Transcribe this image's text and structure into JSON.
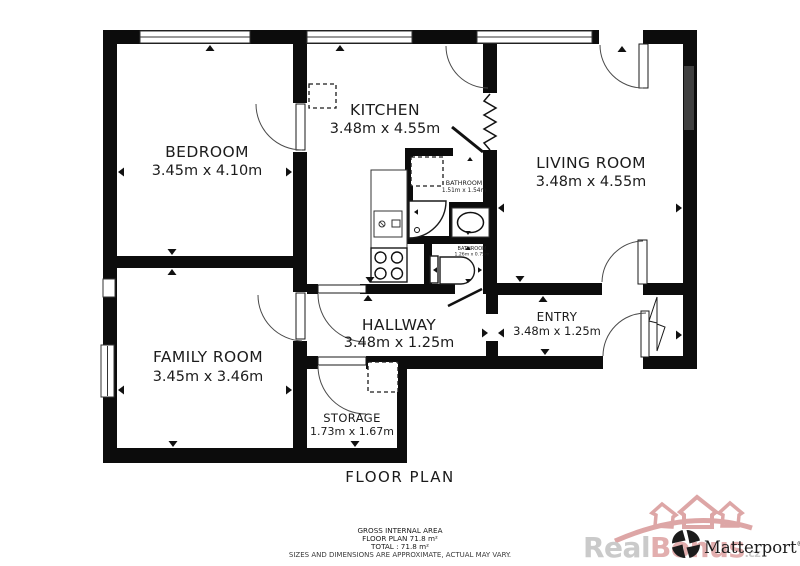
{
  "title": "FLOOR PLAN",
  "rooms": {
    "bedroom": {
      "name": "BEDROOM",
      "dims": "3.45m x 4.10m"
    },
    "kitchen": {
      "name": "KITCHEN",
      "dims": "3.48m x 4.55m"
    },
    "living_room": {
      "name": "LIVING ROOM",
      "dims": "3.48m x 4.55m"
    },
    "family_room": {
      "name": "FAMILY ROOM",
      "dims": "3.45m x 3.46m"
    },
    "hallway": {
      "name": "HALLWAY",
      "dims": "3.48m x 1.25m"
    },
    "entry": {
      "name": "ENTRY",
      "dims": "3.48m x 1.25m"
    },
    "storage": {
      "name": "STORAGE",
      "dims": "1.73m x 1.67m"
    },
    "bathroom": {
      "name": "BATHROOM",
      "dims": "1.51m x 1.54m"
    },
    "bathroom_small": {
      "name": "BATHROOM",
      "dims": "1.26m x 0.75m"
    }
  },
  "summary": {
    "gross_internal_area": "GROSS INTERNAL AREA",
    "floor_plan_area": "FLOOR PLAN 71.8 m²",
    "total_area": "TOTAL :  71.8 m²",
    "disclaimer": "SIZES AND DIMENSIONS ARE APPROXIMATE, ACTUAL MAY VARY."
  },
  "branding": {
    "watermark_prefix": "Real",
    "watermark_suffix": "Bonus",
    "watermark_domain": ".cz",
    "matterport_label": "Matterport",
    "matterport_reg": "®"
  },
  "colors": {
    "wall": "#0c0c0c",
    "watermark_gray": "#c6c6c6",
    "watermark_pink": "#e0a8a8",
    "crown_pink": "#db9f9f",
    "radiator_gray": "#3f3f3f",
    "logo_black": "#1b1b1b"
  }
}
